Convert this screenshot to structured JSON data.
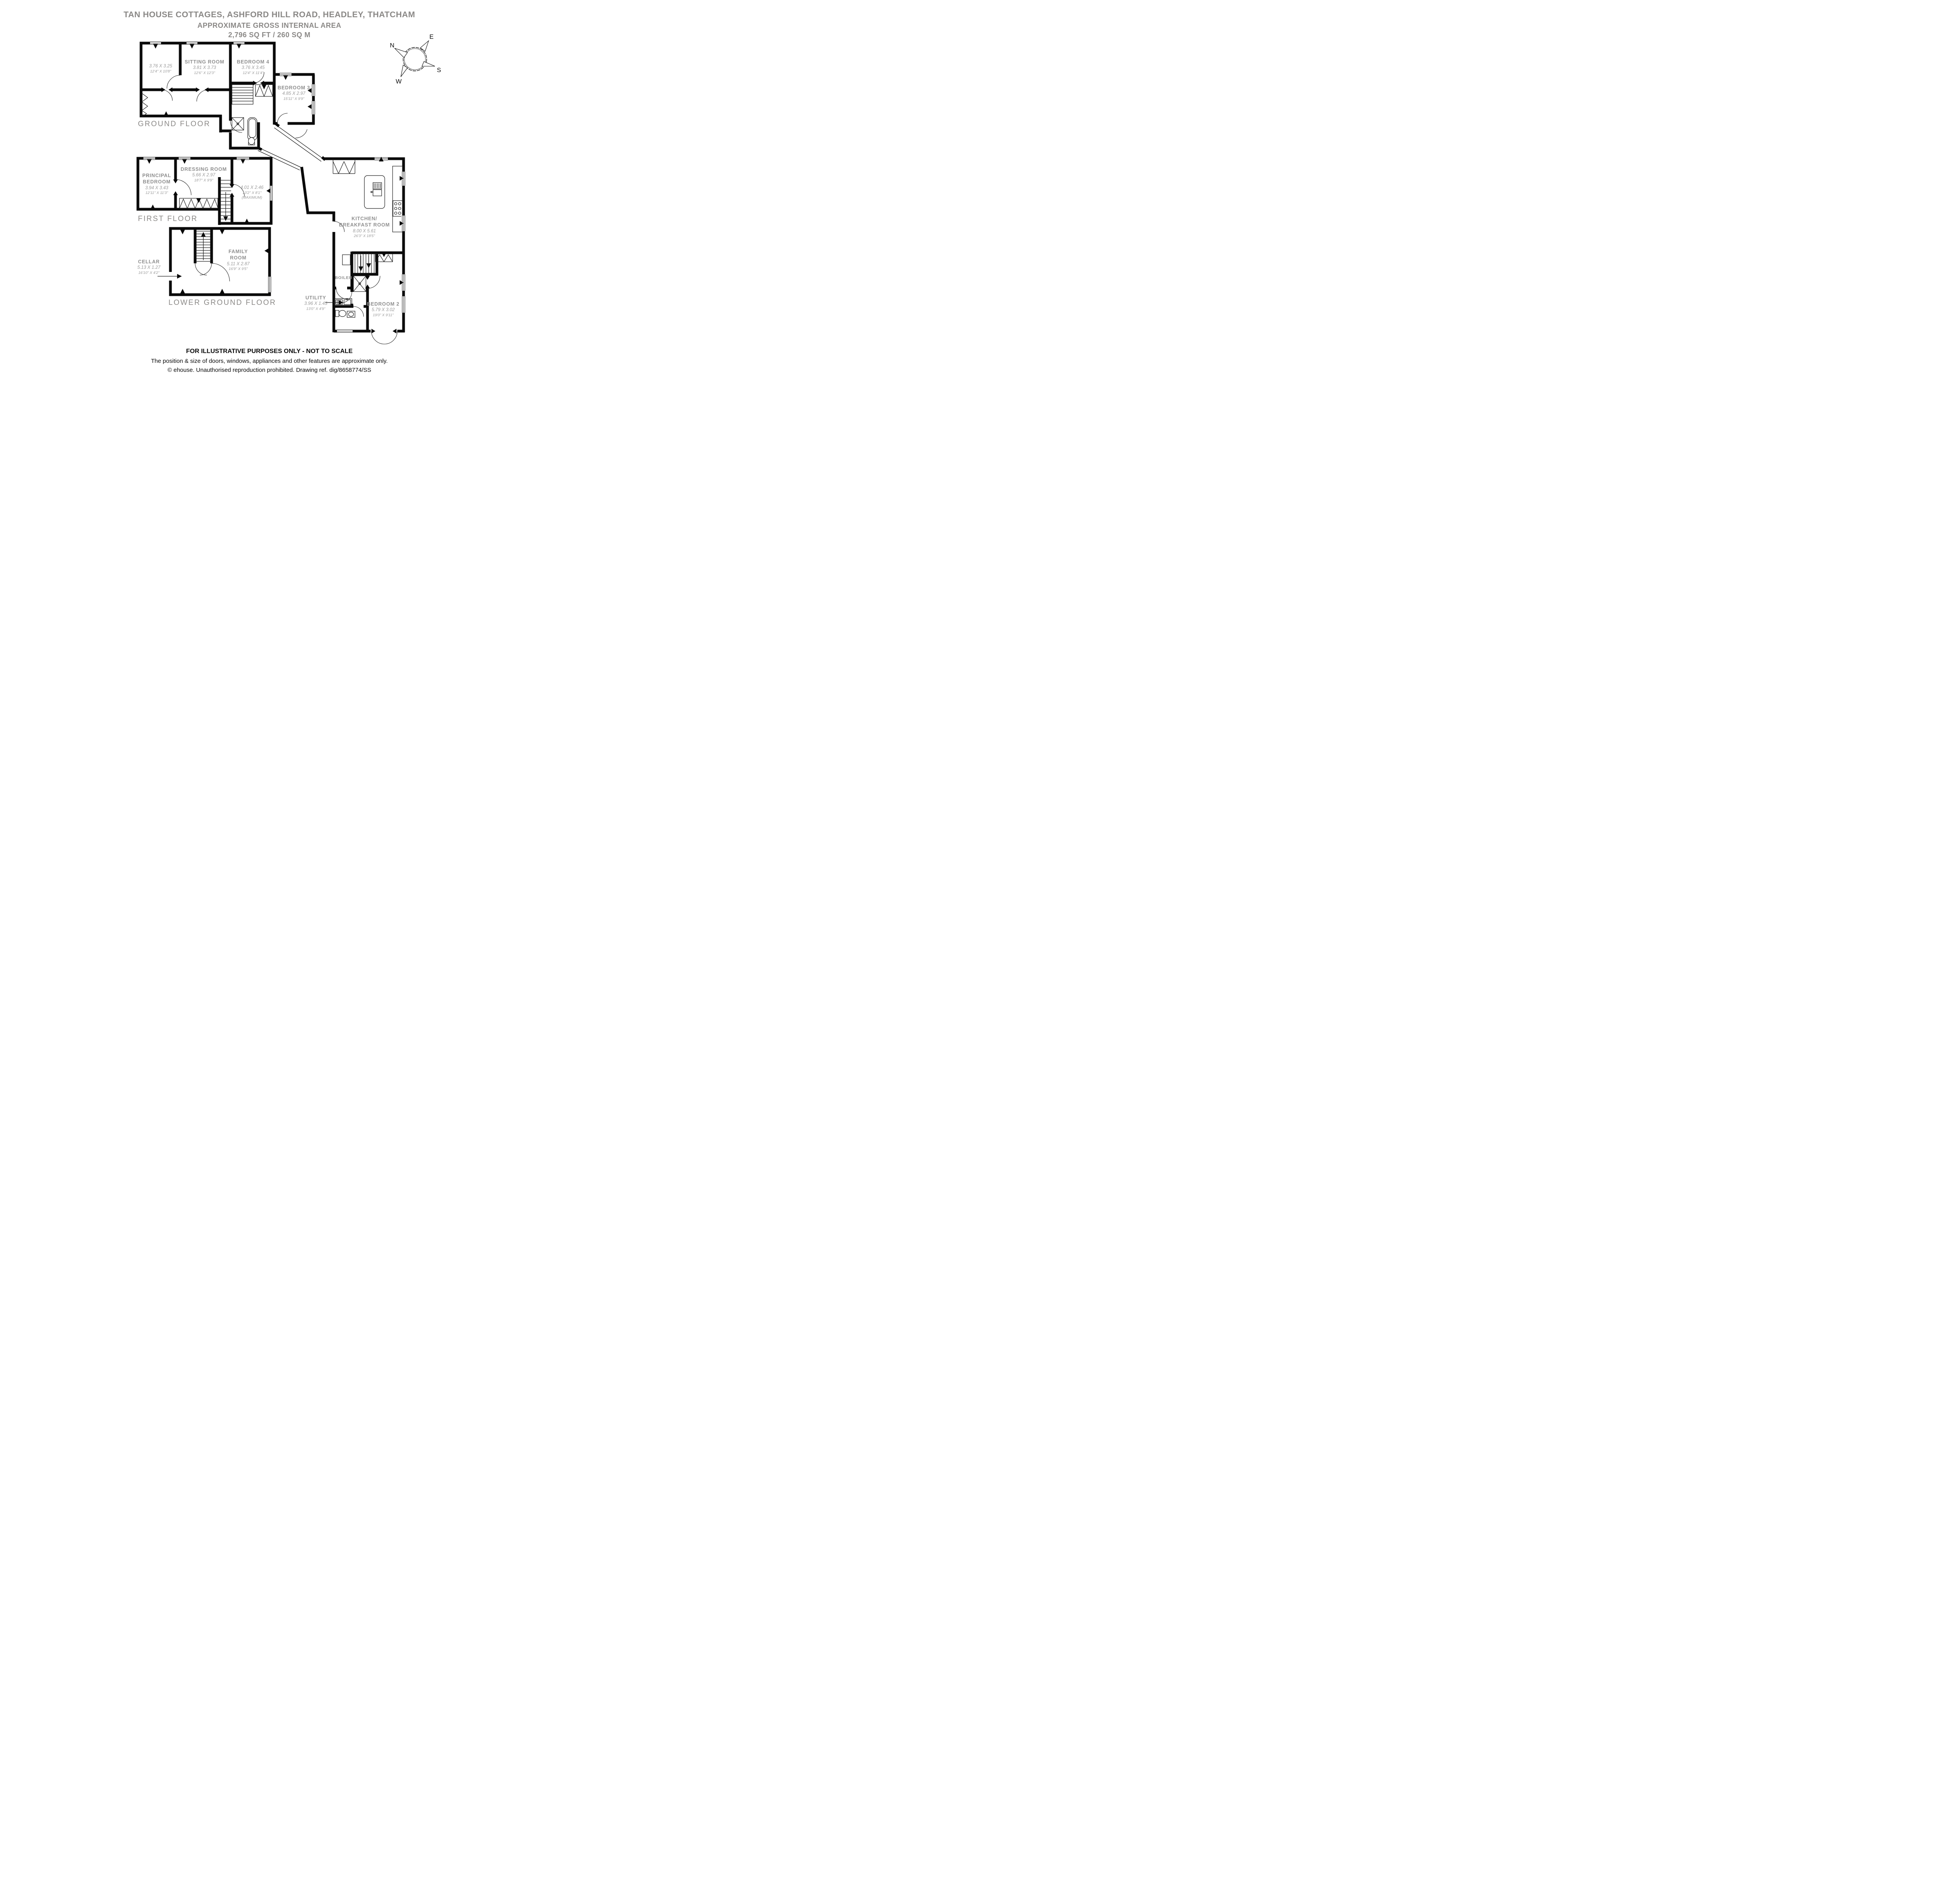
{
  "title": {
    "line1": "TAN HOUSE COTTAGES, ASHFORD HILL ROAD, HEADLEY, THATCHAM",
    "line2": "APPROXIMATE GROSS INTERNAL AREA",
    "line3": "2,796 SQ FT / 260 SQ M"
  },
  "floor_labels": {
    "ground": "GROUND FLOOR",
    "first": "FIRST FLOOR",
    "lower": "LOWER GROUND FLOOR"
  },
  "rooms": {
    "reception": {
      "metric": "3.76 X 3.25",
      "imperial": "12'4\" X 10'8\""
    },
    "sitting": {
      "name": "SITTING ROOM",
      "metric": "3.81 X 3.73",
      "imperial": "12'6\" X 12'3\""
    },
    "bedroom4": {
      "name": "BEDROOM 4",
      "metric": "3.76 X 3.45",
      "imperial": "12'4\" X 11'4\""
    },
    "bedroom3": {
      "name": "BEDROOM 3",
      "metric": "4.85 X 2.97",
      "imperial": "15'11\" X 9'9\""
    },
    "kitchen": {
      "name_line1": "KITCHEN/",
      "name_line2": "BREAKFAST ROOM",
      "metric": "8.00 X 5.61",
      "imperial": "26'3\" X 18'5\""
    },
    "utility": {
      "name": "UTILITY",
      "metric": "3.96 X 1.45",
      "imperial": "13'0\" X 4'9\""
    },
    "boiler": {
      "name": "BOILER"
    },
    "bedroom2": {
      "name": "BEDROOM 2",
      "metric": "5.79 X 3.02",
      "imperial": "19'0\" X 9'11\""
    },
    "principal": {
      "name_line1": "PRINCIPAL",
      "name_line2": "BEDROOM",
      "metric": "3.94 X 3.43",
      "imperial": "12'11\" X 11'3\""
    },
    "dressing": {
      "name": "DRESSING ROOM",
      "metric": "5.66 X 2.97",
      "imperial": "18'7\" X 9'9\""
    },
    "landing": {
      "metric": "4.01 X 2.46",
      "imperial": "13'2\" X 8'1\"",
      "note": "(MAXIMUM)"
    },
    "cellar": {
      "name": "CELLAR",
      "metric": "5.13 X 1.27",
      "imperial": "16'10\" X 4'2\""
    },
    "family": {
      "name_line1": "FAMILY",
      "name_line2": "ROOM",
      "metric": "5.11 X 2.87",
      "imperial": "16'9\" X 9'5\""
    }
  },
  "compass": {
    "north": "N",
    "east": "E",
    "south": "S",
    "west": "W"
  },
  "footer": {
    "line1": "FOR ILLUSTRATIVE PURPOSES ONLY - NOT TO SCALE",
    "line2": "The position & size of doors, windows, appliances and other features are approximate only.",
    "line3": "© ehouse. Unauthorised reproduction prohibited. Drawing ref. dig/8658774/SS"
  },
  "colors": {
    "wall": "#0a0a0a",
    "room_name": "#8f8f8f",
    "dimensions": "#9a9a9a",
    "title": "#8a8886"
  }
}
